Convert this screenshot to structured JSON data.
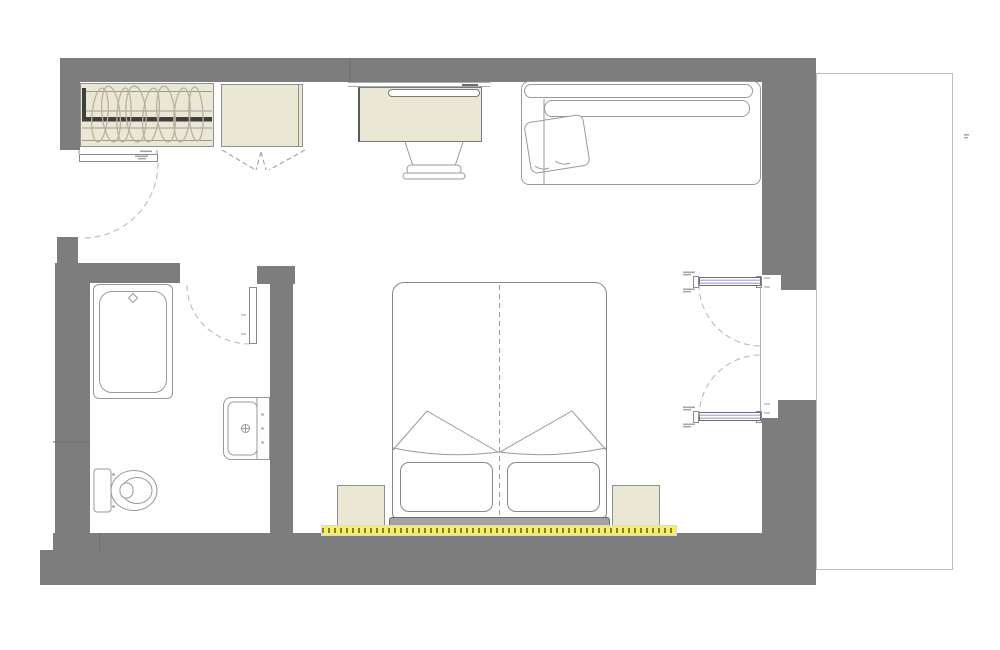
{
  "document": {
    "type": "architectural-floor-plan",
    "subject": "hotel-guest-room-with-ensuite-bathroom-and-balcony",
    "visible_text": "none-legible",
    "annotations": {
      "dimension_marks_present": true,
      "dimension_marks_legible": false
    }
  },
  "colors": {
    "wall": "#7d7d7d",
    "beige": "#ebe7d5",
    "beige_border": "#8f8f8f",
    "outline": "#9a9a9a",
    "furn_border": "#7a7a7a",
    "glazing": "#b7bade",
    "heater": "#f3ef66",
    "heater_dash": "#8a7f2e",
    "headboard": "#a3a3a3",
    "arc": "#b5b5b5",
    "balcony_line": "#bdbdbd",
    "rod": "#3f3f3f",
    "mark": "#a5a5a5",
    "seam": "#6e6e6e",
    "background": "#ffffff"
  },
  "rooms": {
    "bedroom": {
      "furniture": [
        "wardrobe-with-hangers",
        "luggage-cabinet-bifold",
        "desk",
        "desk-chair",
        "sofa",
        "throw-pillow",
        "double-bed",
        "bed-pillow-left",
        "bed-pillow-right",
        "headboard",
        "nightstand-left",
        "nightstand-right",
        "heater-strip"
      ]
    },
    "bathroom": {
      "fixtures": [
        "bathtub",
        "washbasin",
        "toilet"
      ]
    },
    "balcony": {
      "outline_only": true
    }
  },
  "doors": [
    "entry-door-swing",
    "bathroom-door-swing",
    "balcony-french-door-top",
    "balcony-french-door-bottom"
  ],
  "icons": [
    "tub-faucet-diamond-icon",
    "basin-faucet-icon",
    "hanger-loop-icons",
    "bifold-door-dash-icon"
  ]
}
